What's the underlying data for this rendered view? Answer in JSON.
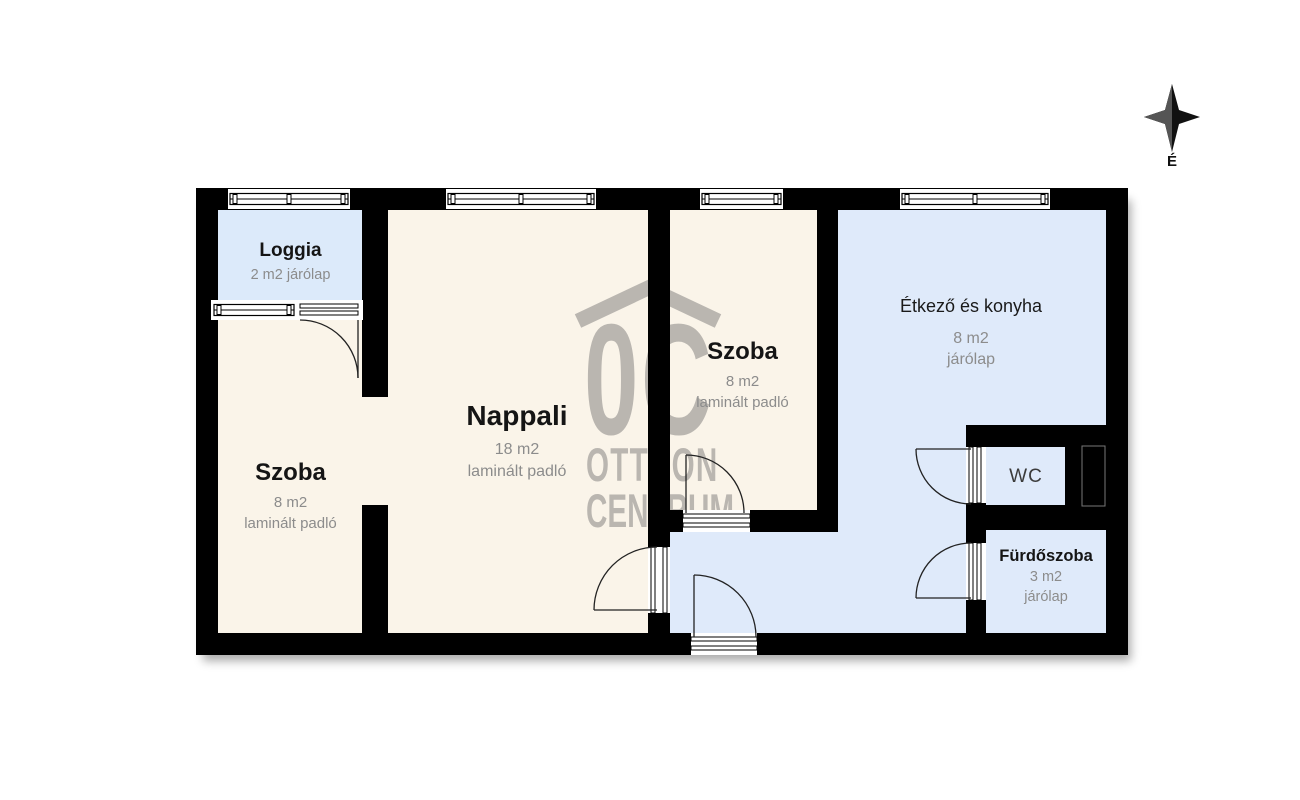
{
  "compass": {
    "label": "É"
  },
  "watermark": {
    "logo": "0C",
    "line1": "OTTHON",
    "line2": "CENTRUM",
    "color": "#b5b1ac"
  },
  "colors": {
    "wall": "#000000",
    "laminate_floor": "#faf4e9",
    "tile_floor": "#dfeafa",
    "loggia_floor": "#dceafa",
    "muted_label": "#8c8c8c"
  },
  "rooms": [
    {
      "name": "Loggia",
      "details": "2 m2 járólap"
    },
    {
      "name": "Szoba",
      "area": "8 m2",
      "floor": "laminált padló"
    },
    {
      "name": "Nappali",
      "area": "18 m2",
      "floor": "laminált padló"
    },
    {
      "name": "Szoba",
      "area": "8 m2",
      "floor": "laminált padló"
    },
    {
      "name": "Étkező és konyha",
      "area": "8 m2",
      "floor": "járólap"
    },
    {
      "name": "WC"
    },
    {
      "name": "Fürdőszoba",
      "area": "3 m2",
      "floor": "járólap"
    }
  ]
}
